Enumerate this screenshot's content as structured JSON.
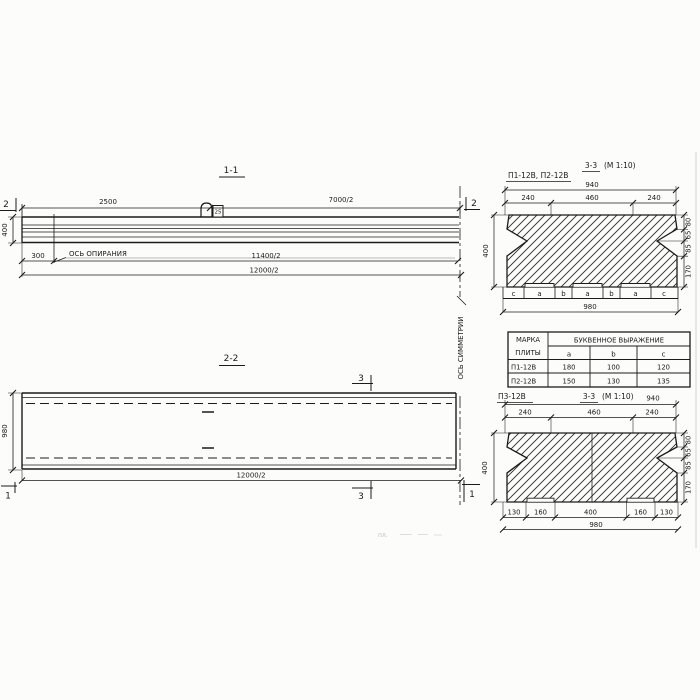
{
  "s11": {
    "title": "1-1",
    "dim_2500": "2500",
    "dim_7000": "7000/2",
    "dim_300": "300",
    "dim_11400": "11400/2",
    "dim_12000": "12000/2",
    "height": "400",
    "marker": "2",
    "bearing_label": "ОСЬ ОПИРАНИЯ",
    "loop_tag": "25"
  },
  "sym_axis_label": "ОСЬ СИММЕТРИИ",
  "s22": {
    "title": "2-2",
    "width": "980",
    "length": "12000/2",
    "marker3": "3",
    "marker1": "1"
  },
  "s33a": {
    "label": "П1-12В, П2-12В",
    "title": "3-3",
    "scale": "(М 1:10)",
    "total_top": "940",
    "top_dims": [
      "240",
      "460",
      "240"
    ],
    "height": "400",
    "right_dims": [
      "80",
      "65",
      "85",
      "170"
    ],
    "letters": [
      "c",
      "a",
      "b",
      "a",
      "b",
      "a",
      "c"
    ],
    "total_bottom": "980"
  },
  "table": {
    "mark_header": [
      "МАРКА",
      "ПЛИТЫ"
    ],
    "group_header": "БУКВЕННОЕ ВЫРАЖЕНИЕ",
    "cols": [
      "a",
      "b",
      "c"
    ],
    "rows": [
      [
        "П1-12В",
        "180",
        "100",
        "120"
      ],
      [
        "П2-12В",
        "150",
        "130",
        "135"
      ]
    ]
  },
  "s33b": {
    "label": "П3-12В",
    "title": "3-3",
    "scale": "(М 1:10)",
    "total_top": "940",
    "top_dims": [
      "240",
      "460",
      "240"
    ],
    "height": "400",
    "right_dims": [
      "80",
      "65",
      "85",
      "170"
    ],
    "bottom_dims": [
      "130",
      "160",
      "400",
      "160",
      "130"
    ],
    "total_bottom": "980"
  },
  "artifact": "пл."
}
